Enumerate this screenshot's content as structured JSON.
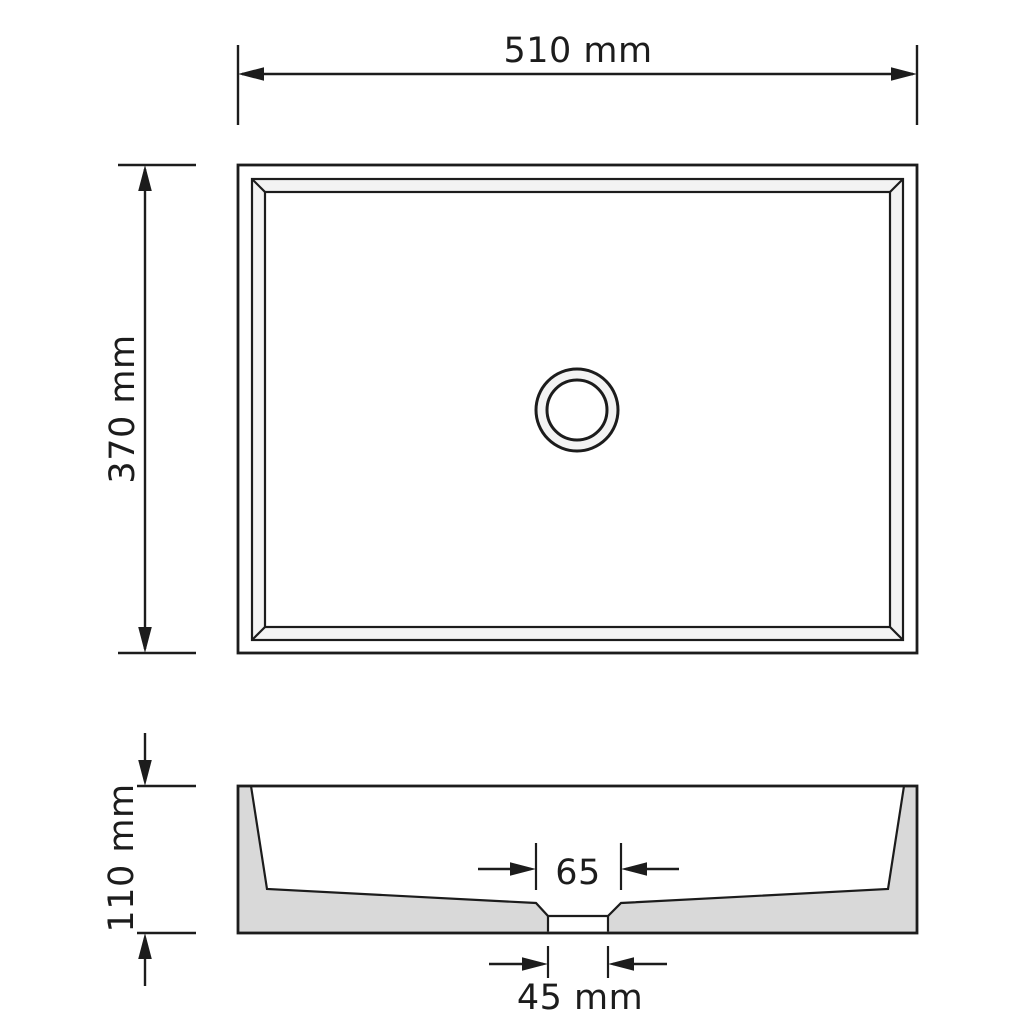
{
  "background": "#ffffff",
  "drawing": {
    "colors": {
      "line": "#1c1c1c",
      "text": "#1c1c1c",
      "section_fill": "#d9d9d9",
      "rim_fill": "#f3f3f3",
      "white": "#ffffff"
    },
    "dimensions": {
      "overall_width": {
        "label": "510 mm",
        "value_mm": 510
      },
      "overall_depth": {
        "label": "370 mm",
        "value_mm": 370
      },
      "overall_height": {
        "label": "110 mm",
        "value_mm": 110
      },
      "drain_recess_width": {
        "label": "65",
        "value_mm": 65
      },
      "drain_hole_width": {
        "label": "45 mm",
        "value_mm": 45
      }
    }
  }
}
